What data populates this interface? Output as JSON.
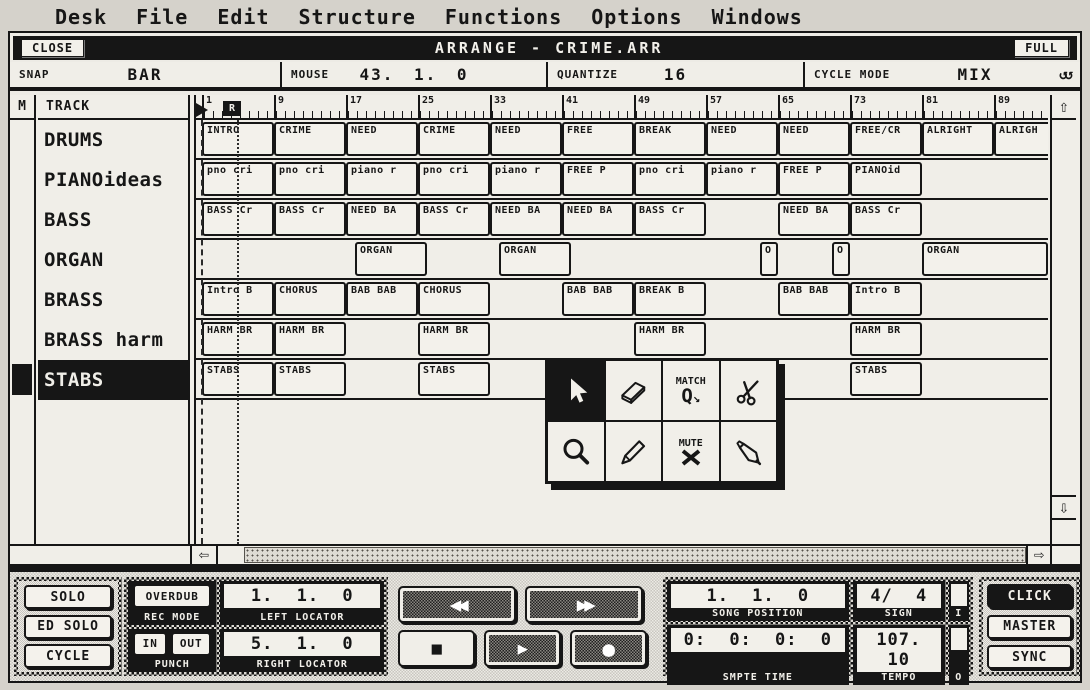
{
  "menu": {
    "items": [
      "Desk",
      "File",
      "Edit",
      "Structure",
      "Functions",
      "Options",
      "Windows"
    ]
  },
  "window": {
    "close_label": "CLOSE",
    "title": "ARRANGE - CRIME.ARR",
    "full_label": "FULL"
  },
  "info_bar": {
    "snap_label": "SNAP",
    "snap_value": "BAR",
    "mouse_label": "MOUSE",
    "mouse_value": "43. 1. 0",
    "quantize_label": "QUANTIZE",
    "quantize_value": "16",
    "cycle_mode_label": "CYCLE MODE",
    "cycle_mode_value": "MIX",
    "cycle_icon": "loop-arrows-icon"
  },
  "track_list": {
    "mute_header": "M",
    "track_header": "TRACK",
    "tracks": [
      {
        "name": "DRUMS",
        "selected": false
      },
      {
        "name": "PIANOideas",
        "selected": false
      },
      {
        "name": "BASS",
        "selected": false
      },
      {
        "name": "ORGAN",
        "selected": false
      },
      {
        "name": "BRASS",
        "selected": false
      },
      {
        "name": "BRASS harm",
        "selected": false
      },
      {
        "name": "STABS",
        "selected": true
      }
    ]
  },
  "ruler": {
    "bar_numbers": [
      1,
      9,
      17,
      25,
      33,
      41,
      49,
      57,
      65,
      73,
      81,
      89
    ],
    "left_locator_marker": "flag",
    "right_locator_marker": "R"
  },
  "arrangement": {
    "lanes": [
      {
        "track": "DRUMS",
        "parts": [
          {
            "label": "INTRO",
            "start": 1,
            "len": 8
          },
          {
            "label": "CRIME",
            "start": 9,
            "len": 8
          },
          {
            "label": "NEED",
            "start": 17,
            "len": 8
          },
          {
            "label": "CRIME",
            "start": 25,
            "len": 8
          },
          {
            "label": "NEED",
            "start": 33,
            "len": 8
          },
          {
            "label": "FREE",
            "start": 41,
            "len": 8
          },
          {
            "label": "BREAK",
            "start": 49,
            "len": 8
          },
          {
            "label": "NEED",
            "start": 57,
            "len": 8
          },
          {
            "label": "NEED",
            "start": 65,
            "len": 8
          },
          {
            "label": "FREE/CR",
            "start": 73,
            "len": 8
          },
          {
            "label": "ALRIGHT",
            "start": 81,
            "len": 8
          },
          {
            "label": "ALRIGH",
            "start": 89,
            "len": 8
          }
        ]
      },
      {
        "track": "PIANOideas",
        "parts": [
          {
            "label": "pno cri",
            "start": 1,
            "len": 8
          },
          {
            "label": "pno cri",
            "start": 9,
            "len": 8
          },
          {
            "label": "piano r",
            "start": 17,
            "len": 8
          },
          {
            "label": "pno cri",
            "start": 25,
            "len": 8
          },
          {
            "label": "piano r",
            "start": 33,
            "len": 8
          },
          {
            "label": "FREE P",
            "start": 41,
            "len": 8
          },
          {
            "label": "pno cri",
            "start": 49,
            "len": 8
          },
          {
            "label": "piano r",
            "start": 57,
            "len": 8
          },
          {
            "label": "FREE P",
            "start": 65,
            "len": 8
          },
          {
            "label": "PIANOid",
            "start": 73,
            "len": 8
          }
        ]
      },
      {
        "track": "BASS",
        "parts": [
          {
            "label": "BASS Cr",
            "start": 1,
            "len": 8
          },
          {
            "label": "BASS Cr",
            "start": 9,
            "len": 8
          },
          {
            "label": "NEED BA",
            "start": 17,
            "len": 8
          },
          {
            "label": "BASS Cr",
            "start": 25,
            "len": 8
          },
          {
            "label": "NEED BA",
            "start": 33,
            "len": 8
          },
          {
            "label": "NEED BA",
            "start": 41,
            "len": 8
          },
          {
            "label": "BASS Cr",
            "start": 49,
            "len": 8
          },
          {
            "label": "NEED BA",
            "start": 65,
            "len": 8
          },
          {
            "label": "BASS Cr",
            "start": 73,
            "len": 8
          }
        ]
      },
      {
        "track": "ORGAN",
        "parts": [
          {
            "label": "ORGAN",
            "start": 18,
            "len": 8
          },
          {
            "label": "ORGAN",
            "start": 34,
            "len": 8
          },
          {
            "label": "O",
            "start": 63,
            "len": 2
          },
          {
            "label": "O",
            "start": 71,
            "len": 2
          },
          {
            "label": "ORGAN",
            "start": 81,
            "len": 14
          }
        ]
      },
      {
        "track": "BRASS",
        "parts": [
          {
            "label": "Intro B",
            "start": 1,
            "len": 8
          },
          {
            "label": "CHORUS",
            "start": 9,
            "len": 8
          },
          {
            "label": "BAB BAB",
            "start": 17,
            "len": 8
          },
          {
            "label": "CHORUS",
            "start": 25,
            "len": 8
          },
          {
            "label": "BAB BAB",
            "start": 41,
            "len": 8
          },
          {
            "label": "BREAK B",
            "start": 49,
            "len": 8
          },
          {
            "label": "BAB BAB",
            "start": 65,
            "len": 8
          },
          {
            "label": "Intro B",
            "start": 73,
            "len": 8
          }
        ]
      },
      {
        "track": "BRASS harm",
        "parts": [
          {
            "label": "HARM BR",
            "start": 1,
            "len": 8
          },
          {
            "label": "HARM BR",
            "start": 9,
            "len": 8
          },
          {
            "label": "HARM BR",
            "start": 25,
            "len": 8
          },
          {
            "label": "HARM BR",
            "start": 49,
            "len": 8
          },
          {
            "label": "HARM BR",
            "start": 73,
            "len": 8
          }
        ]
      },
      {
        "track": "STABS",
        "parts": [
          {
            "label": "STABS",
            "start": 1,
            "len": 8
          },
          {
            "label": "STABS",
            "start": 9,
            "len": 8
          },
          {
            "label": "STABS",
            "start": 25,
            "len": 8
          },
          {
            "label": "STABS",
            "start": 73,
            "len": 8
          }
        ]
      }
    ]
  },
  "toolbox": {
    "tools": [
      {
        "name": "pointer-tool",
        "selected": true
      },
      {
        "name": "eraser-tool",
        "selected": false
      },
      {
        "name": "match-quantize-tool",
        "selected": false,
        "label": "MATCH",
        "glyph": "Q"
      },
      {
        "name": "scissors-tool",
        "selected": false
      },
      {
        "name": "magnify-tool",
        "selected": false
      },
      {
        "name": "pencil-tool",
        "selected": false
      },
      {
        "name": "mute-tool",
        "selected": false,
        "label": "MUTE"
      },
      {
        "name": "glue-tool",
        "selected": false
      }
    ]
  },
  "transport": {
    "solo": "SOLO",
    "ed_solo": "ED SOLO",
    "cycle": "CYCLE",
    "overdub": "OVERDUB",
    "rec_mode_label": "REC MODE",
    "punch_in": "IN",
    "punch_out": "OUT",
    "punch_label": "PUNCH",
    "left_locator_value": "1. 1. 0",
    "left_locator_label": "LEFT LOCATOR",
    "right_locator_value": "5. 1. 0",
    "right_locator_label": "RIGHT LOCATOR",
    "song_position_value": "1. 1. 0",
    "song_position_label": "SONG POSITION",
    "sign_value": "4/ 4",
    "sign_label": "SIGN",
    "midi_in_label": "I",
    "midi_out_label": "O",
    "smpte_value": "0: 0: 0: 0",
    "smpte_label": "SMPTE TIME",
    "tempo_value": "107. 10",
    "tempo_label": "TEMPO",
    "click": "CLICK",
    "master": "MASTER",
    "sync": "SYNC"
  },
  "colors": {
    "ink": "#161616",
    "paper": "#d5d2cb",
    "panel": "#f0eee8"
  }
}
